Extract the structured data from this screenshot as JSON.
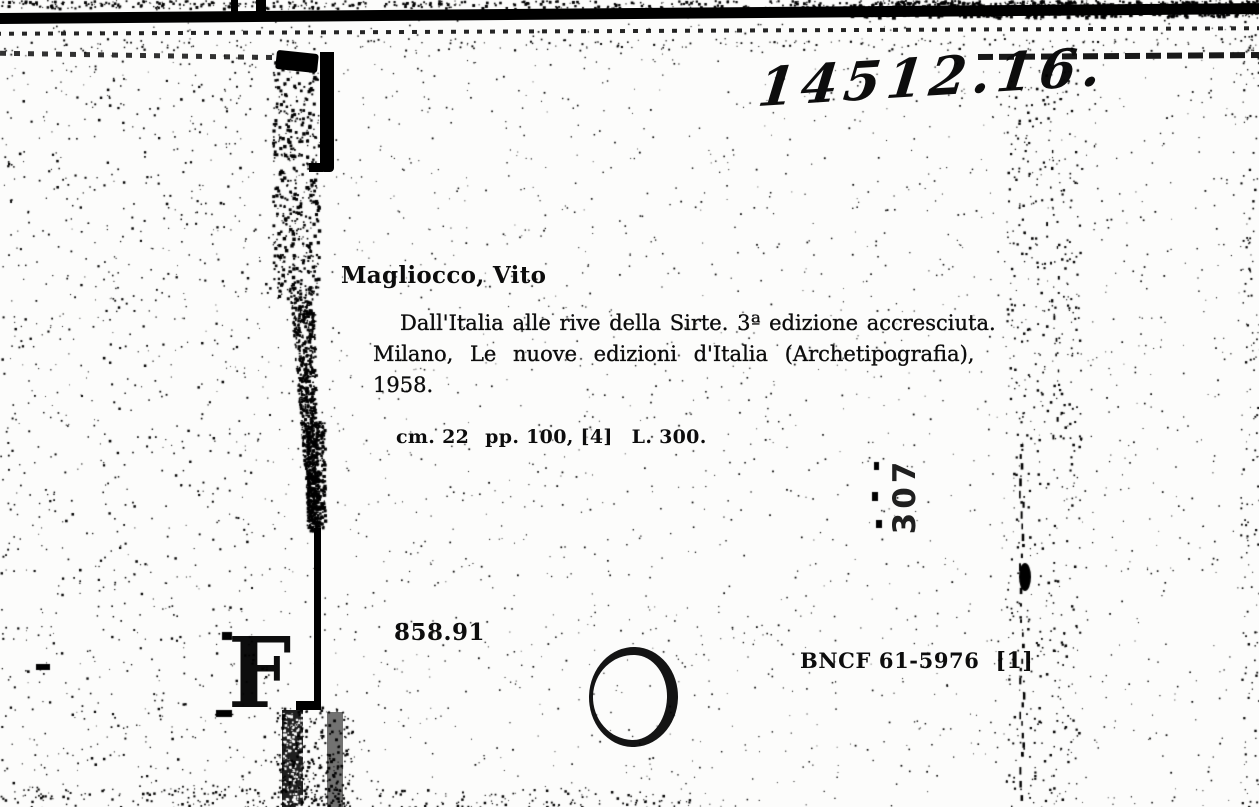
{
  "card": {
    "handwritten_shelfmark": "14512.16.",
    "author_heading": "Magliocco, Vito",
    "title_lines": [
      "Dall'Italia alle rive della Sirte. 3ª edizione accresciuta.",
      "Milano, Le nuove edizioni d'Italia (Archetipografia),",
      "1958."
    ],
    "collation": {
      "size": "cm. 22",
      "pages": "pp. 100, [4]",
      "price": "L. 300."
    },
    "stamp_number": "307",
    "call_number": "858.91",
    "accession_number": "BNCF 61-5976",
    "copy_marker": "[1]",
    "corner_letter": "F"
  },
  "colors": {
    "ink": "#0d0d0d",
    "paper": "#fcfcfb"
  }
}
